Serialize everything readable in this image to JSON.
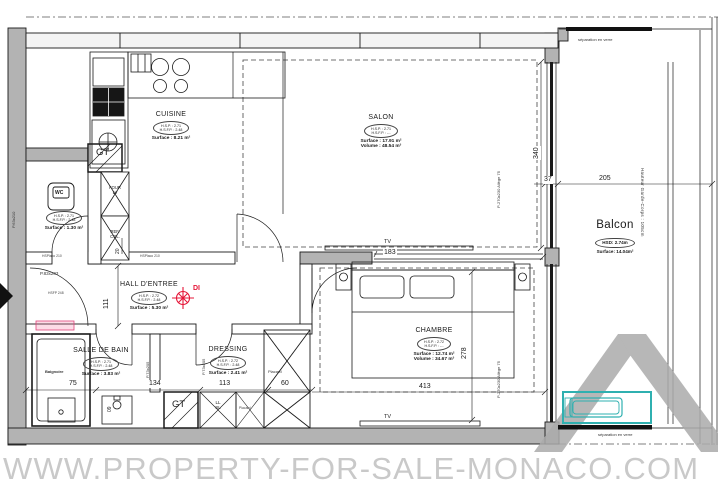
{
  "watermark": {
    "url_text": "WWW.PROPERTY-FOR-SALE-MONACO.COM"
  },
  "colors": {
    "wall_grey": "#b3b3b3",
    "planter_teal": "#2fb0b0",
    "di_red": "#e51537",
    "watermark_grey": "#c9c9c9"
  },
  "rooms": {
    "cuisine": {
      "name": "CUISINE",
      "line1": "H.S.P. : 2.71",
      "line2": "H.S.F.P. : 2.48",
      "surface": "Surface : 8.21 m²"
    },
    "salon": {
      "name": "SALON",
      "line1": "H.S.P. : 2.71",
      "line2": "H.S.F.P. : -.-",
      "surface": "Surface : 17.91 m²",
      "volume": "Volume : 48.54 m³"
    },
    "chambre": {
      "name": "CHAMBRE",
      "line1": "H.S.P. : 2.72",
      "line2": "H.S.F.P. : -.-",
      "surface": "Surface : 12.74 m²",
      "volume": "Volume : 34.67 m³"
    },
    "hall": {
      "name": "HALL D'ENTREE",
      "line1": "H.S.P. : 2.72",
      "line2": "H.S.F.P. : 2.48",
      "surface": "Surface : 5.30 m²"
    },
    "salle_de_bain": {
      "name": "SALLE DE BAIN",
      "line1": "H.S.P. : 2.71",
      "line2": "H.S.F.P. : 2.48",
      "surface": "Surface : 3.83 m²"
    },
    "dressing": {
      "name": "DRESSING",
      "line1": "H.S.P. : 2.72",
      "line2": "H.S.F.P. : 2.48",
      "surface": "Surface : 2.41 m²"
    },
    "wc": {
      "name": "WC",
      "line1": "H.S.P. : 2.71",
      "line2": "H.S.F.P. : 2.48",
      "surface": "Surface : 1.30 m²"
    },
    "balcon": {
      "name": "Balcon",
      "hsd": "HSD: 2.74m",
      "surface": "Surface: 14.04m²"
    }
  },
  "fixtures": {
    "gt1": "GT",
    "gt2": "GT",
    "four_lv": "FOUR\nLV",
    "ref_cgl": "REF.\nCGL.",
    "ll_sl": "LL\nSL",
    "placard_column": "Placard",
    "placard_strip": "Placard",
    "baignoire": "Baignoire",
    "tv_salon": "TV",
    "tv_chambre": "TV",
    "di": "DI"
  },
  "dims": {
    "d340": "340",
    "d37": "37",
    "d205": "205",
    "d183": "183",
    "d278": "278",
    "d413": "413",
    "d75": "75",
    "d134": "134",
    "d113": "113",
    "d60": "60",
    "d111": "111",
    "d20": "20",
    "d09": "09"
  },
  "annotations": {
    "sep_top": "séparation en verre",
    "sep_bottom": "séparation en verre",
    "garde_corps": "Hauteur Garde-Corps : 105cm",
    "door_entry": "P.83x203",
    "door_entry_hsfp": "HSFP 248",
    "door_wc": "P.63x210",
    "door_sdb": "P.73x205",
    "door_dressing": "P.73x205",
    "window_salon": "P-270x230 Allège 75",
    "window_chambre": "P-270x230 Allège 75",
    "hsplaco_1": "HSPlaco 210",
    "hsplaco_2": "HSPlaco 210"
  }
}
